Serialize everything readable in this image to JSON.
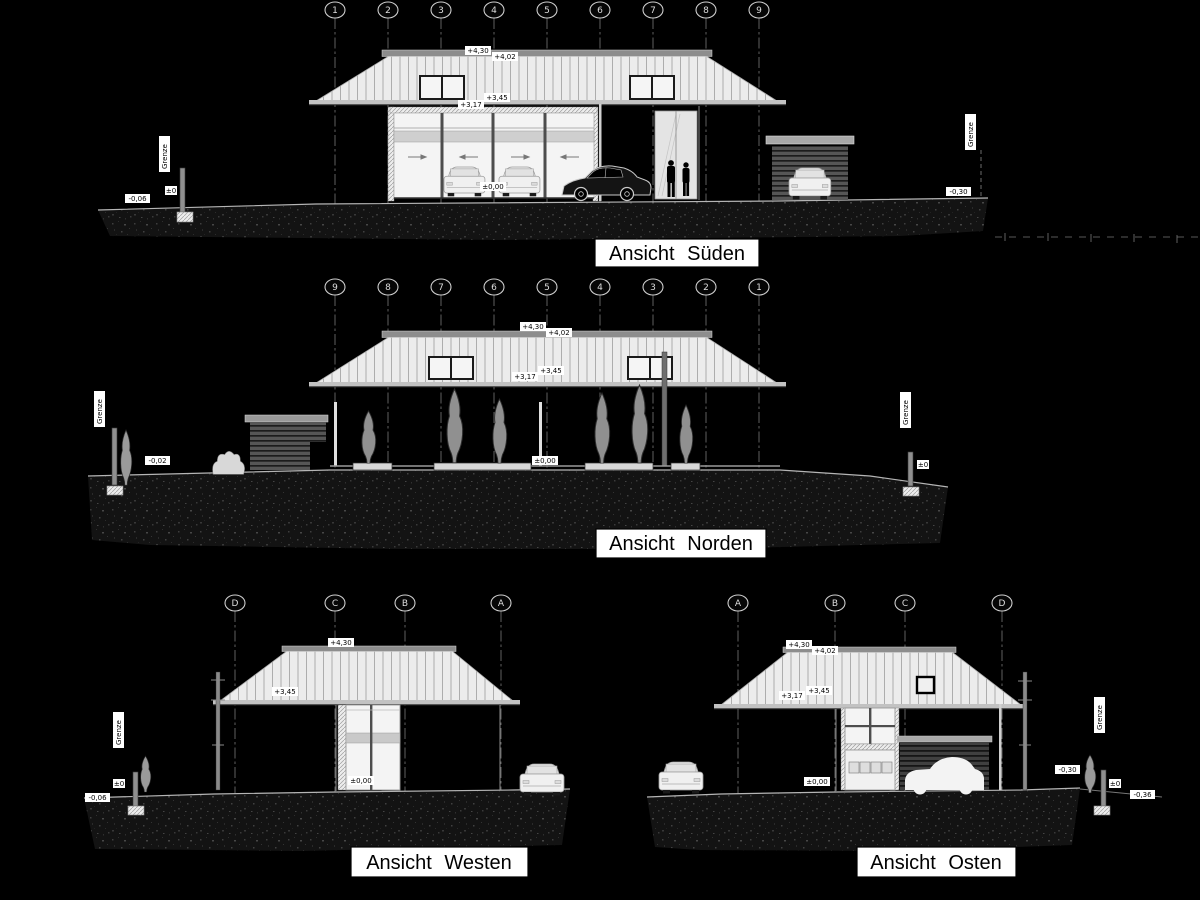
{
  "drawing": {
    "type": "architectural-elevations",
    "background": "#000000",
    "line_color": "#cfcfcf",
    "label_bg": "#ffffff",
    "label_text": "#000000"
  },
  "views": {
    "sued": {
      "title": "Ansicht  Süden",
      "grid": [
        "1",
        "2",
        "3",
        "4",
        "5",
        "6",
        "7",
        "8",
        "9"
      ],
      "labels": {
        "ridge_a": "+4,30",
        "ridge_b": "+4,02",
        "eave_a": "+3,17",
        "eave_b": "+3,45",
        "zero": "±0,00",
        "ground_left": "-0,06",
        "ground_right": "-0,30",
        "grenze_left": "Grenze",
        "grenze_right": "Grenze",
        "post_left": "±0"
      }
    },
    "nord": {
      "title": "Ansicht  Norden",
      "grid": [
        "9",
        "8",
        "7",
        "6",
        "5",
        "4",
        "3",
        "2",
        "1"
      ],
      "labels": {
        "ridge_a": "+4,30",
        "ridge_b": "+4,02",
        "eave_a": "+3,17",
        "eave_b": "+3,45",
        "zero": "±0,00",
        "ground_left": "-0,02",
        "grenze_left": "Grenze",
        "grenze_right": "Grenze",
        "post_right": "±0"
      }
    },
    "west": {
      "title": "Ansicht  Westen",
      "grid": [
        "D",
        "C",
        "B",
        "A"
      ],
      "labels": {
        "ridge_a": "+4,30",
        "eave_b": "+3,45",
        "zero": "±0,00",
        "ground_left": "-0,06",
        "grenze_left": "Grenze",
        "post_left": "±0"
      }
    },
    "ost": {
      "title": "Ansicht  Osten",
      "grid": [
        "A",
        "B",
        "C",
        "D"
      ],
      "labels": {
        "ridge_a": "+4,30",
        "ridge_b": "+4,02",
        "eave_a": "+3,17",
        "eave_b": "+3,45",
        "zero": "±0,00",
        "ground_right_a": "-0,30",
        "ground_right_b": "-0,36",
        "grenze_right": "Grenze",
        "post_right": "±0"
      }
    }
  }
}
